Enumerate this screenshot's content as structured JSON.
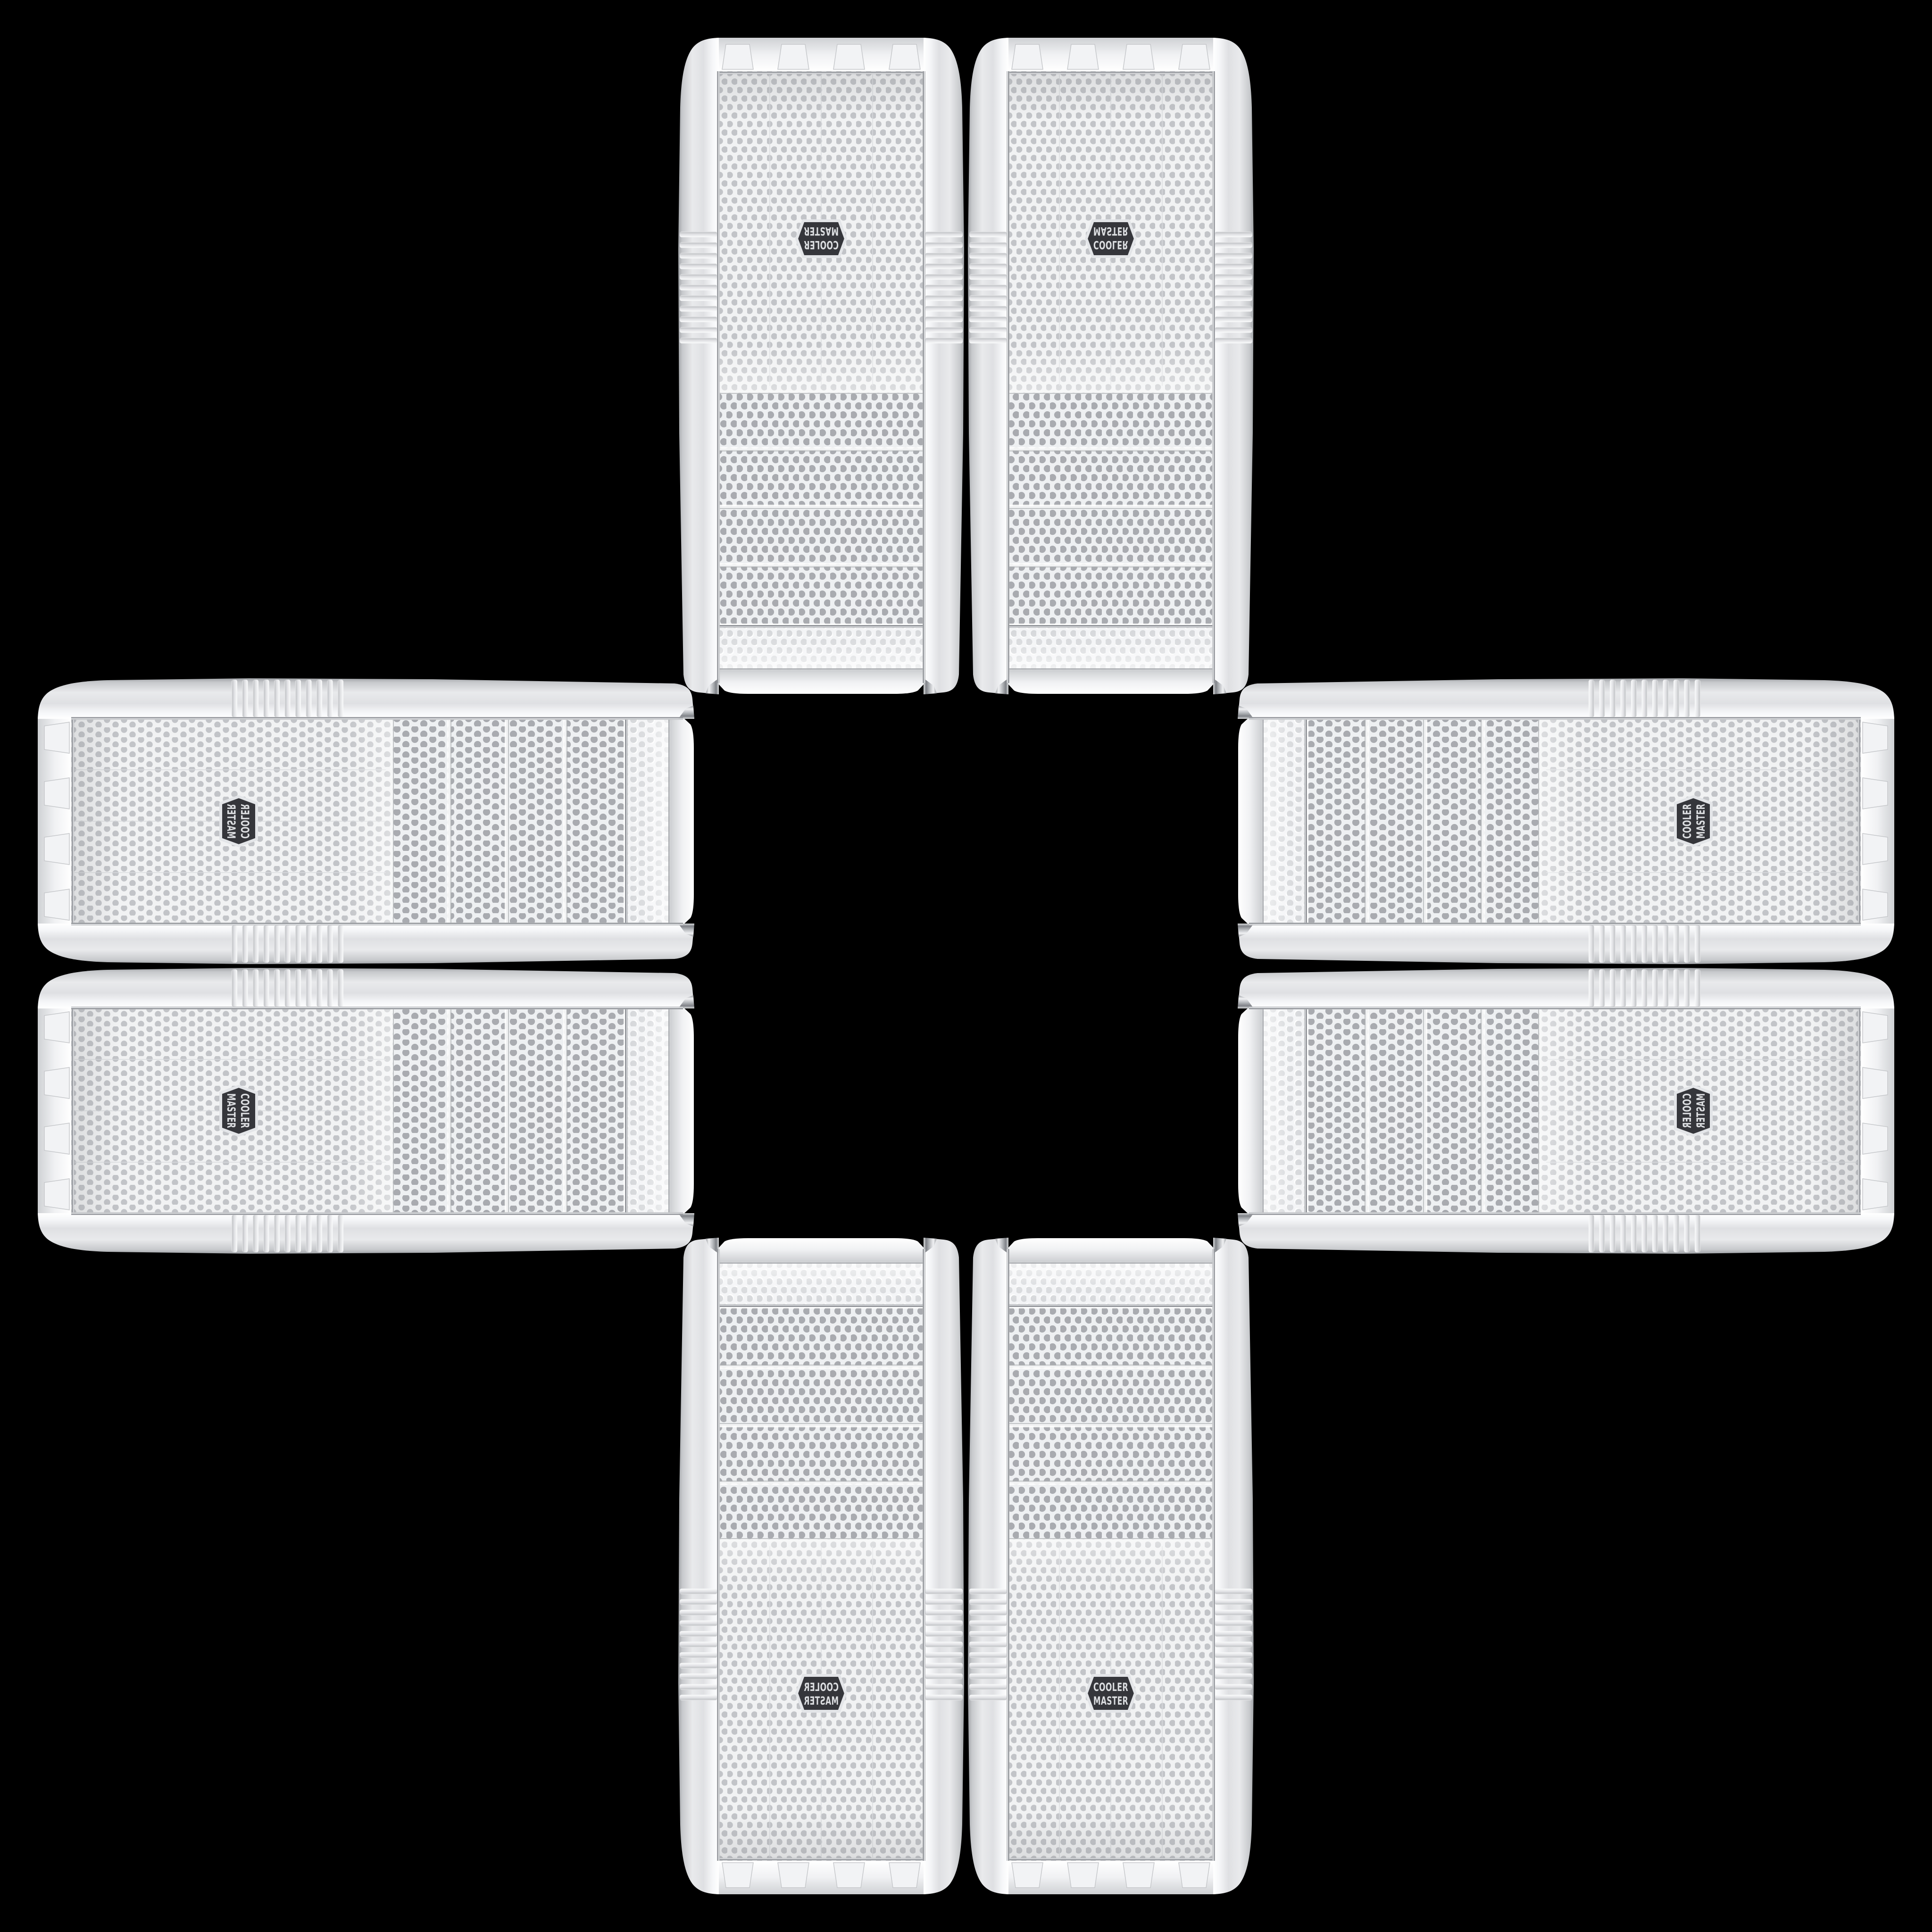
{
  "scene": {
    "background_color": "#000000",
    "layout": "plus-cross collage of eight identical white PC tower cases on black",
    "brand": {
      "line1": "COOLER",
      "line2": "MASTER"
    },
    "palette": {
      "case_white": "#f4f5f7",
      "case_shade": "#c9cbce",
      "mesh_background": "#f1f2f3",
      "mesh_hole_fine": "#c2c4c8",
      "mesh_hole_coarse": "#a9abb0",
      "chrome_trim": "#b9bcc0",
      "badge_background": "#35363b",
      "badge_text": "#dcdee1"
    },
    "cases": [
      {
        "id": "tower-top-left",
        "position": "top arm, left tower",
        "orientation": "rotated-180",
        "transform": "translate(2046,1478) scale(-1,-1)"
      },
      {
        "id": "tower-top-right",
        "position": "top arm, right tower",
        "orientation": "flipped-vertical",
        "transform": "translate(2050,1478) scale(1,-1)"
      },
      {
        "id": "tower-bottom-left",
        "position": "bottom arm, left tower",
        "orientation": "mirrored-horizontal",
        "transform": "translate(2046,2618) scale(-1,1)"
      },
      {
        "id": "tower-bottom-right",
        "position": "bottom arm, right tower",
        "orientation": "upright-original",
        "transform": "translate(2050,2618)"
      },
      {
        "id": "case-left-top",
        "position": "left arm, upper case",
        "orientation": "rotated-90-mirrored",
        "transform": "translate(1478,2046) scale(-1,1) rotate(-90)"
      },
      {
        "id": "case-left-bottom",
        "position": "left arm, lower case",
        "orientation": "rotated-90",
        "transform": "translate(1478,2050) rotate(90)"
      },
      {
        "id": "case-right-top",
        "position": "right arm, upper case",
        "orientation": "rotated-270",
        "transform": "translate(2618,2046) rotate(-90)"
      },
      {
        "id": "case-right-bottom",
        "position": "right arm, lower case",
        "orientation": "rotated-270-mirrored",
        "transform": "translate(2618,2050) scale(1,-1) rotate(-90)"
      }
    ]
  }
}
